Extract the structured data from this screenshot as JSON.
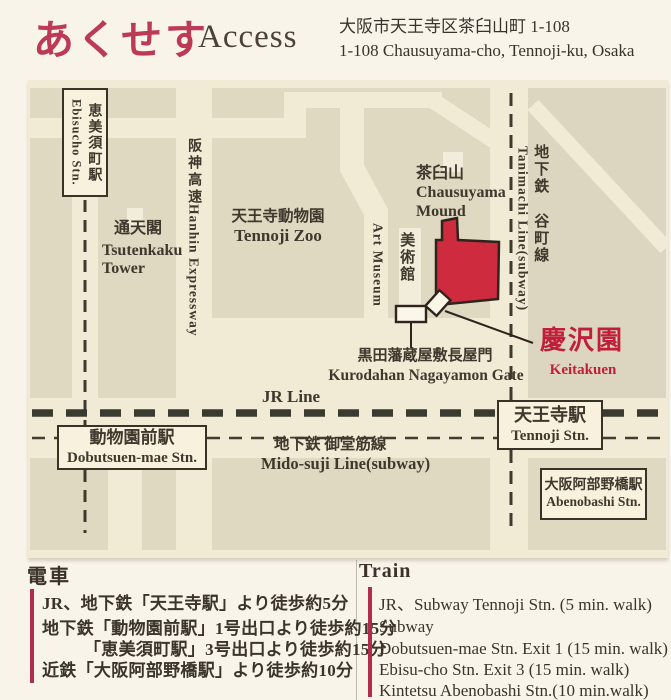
{
  "header": {
    "title_jp": "あくせす",
    "title_en": "Access",
    "address_jp": "大阪市天王寺区茶臼山町 1-108",
    "address_en": "1-108 Chausuyama-cho, Tennoji-ku, Osaka"
  },
  "map": {
    "stations": {
      "ebisucho": {
        "jp": "恵美須町駅",
        "en": "Ebisucho Stn."
      },
      "dobutsuenmae": {
        "jp": "動物園前駅",
        "en": "Dobutsuen-mae Stn."
      },
      "tennoji": {
        "jp": "天王寺駅",
        "en": "Tennoji Stn."
      },
      "abenobashi": {
        "jp": "大阪阿部野橋駅",
        "en": "Abenobashi Stn."
      }
    },
    "landmarks": {
      "tsutenkaku": {
        "jp": "通天閣",
        "en1": "Tsutenkaku",
        "en2": "Tower"
      },
      "zoo": {
        "jp": "天王寺動物園",
        "en": "Tennoji Zoo"
      },
      "chausuyama": {
        "jp": "茶臼山",
        "en1": "Chausuyama",
        "en2": "Mound"
      },
      "art_museum": {
        "jp": "美術館",
        "en": "Art Museum"
      },
      "gate": {
        "jp": "黒田藩蔵屋敷長屋門",
        "en": "Kurodahan Nagayamon Gate"
      },
      "keitakuen": {
        "jp": "慶沢園",
        "en": "Keitakuen"
      }
    },
    "lines": {
      "hanshin_jp": "阪神高速",
      "hanshin_en": "Hanhin Expressway",
      "tanimachi_jp": "地下鉄 谷町線",
      "tanimachi_en": "Tanimachi Line(subway)",
      "jr": "JR Line",
      "midosuji_jp": "地下鉄 御堂筋線",
      "midosuji_en": "Mido-suji Line(subway)"
    }
  },
  "access": {
    "jp": {
      "heading": "電車",
      "lines": [
        "JR、地下鉄「天王寺駅」より徒歩約5分",
        "地下鉄「動物園前駅」1号出口より徒歩約15分",
        "「恵美須町駅」3号出口より徒歩約15分",
        "近鉄「大阪阿部野橋駅」より徒歩約10分"
      ]
    },
    "en": {
      "heading": "Train",
      "lines": [
        "JR、Subway Tennoji Stn. (5 min. walk)",
        "Subway",
        "Dobutsuen-mae Stn. Exit 1 (15 min. walk)",
        "Ebisu-cho Stn. Exit 3 (15 min. walk)",
        "Kintetsu  Abenobashi Stn.(10 min.walk)"
      ]
    }
  },
  "colors": {
    "accent_red": "#bc3a56",
    "garden_red": "#cf2b3f",
    "label_red": "#c01f39",
    "map_street": "#f1ead5",
    "map_block": "#e0d9c1"
  }
}
